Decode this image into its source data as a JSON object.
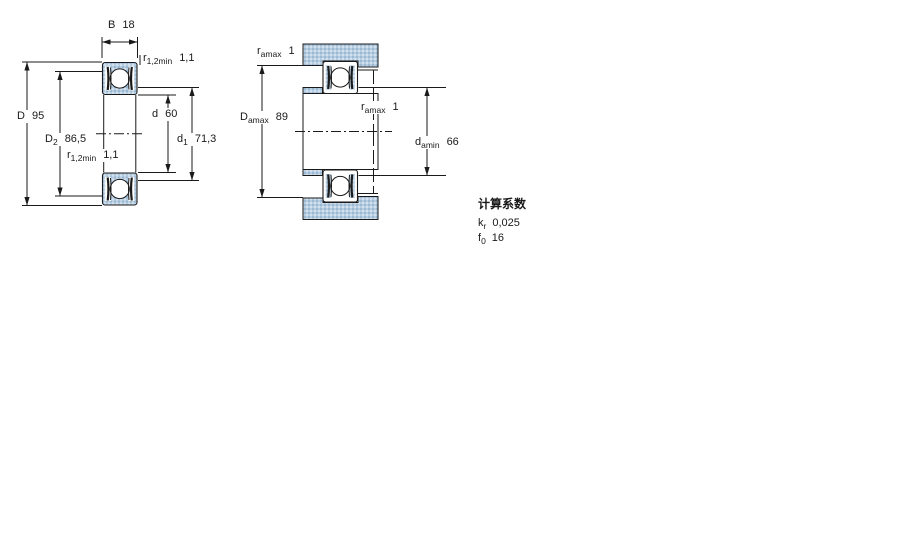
{
  "figures": {
    "left": {
      "name": "bearing-cross-section",
      "dims": {
        "B": {
          "base": "B",
          "sub": "",
          "value": "18"
        },
        "D": {
          "base": "D",
          "sub": "",
          "value": "95"
        },
        "D2": {
          "base": "D",
          "sub": "2",
          "value": "86,5"
        },
        "r_top": {
          "base": "r",
          "sub": "1,2min",
          "value": "1,1"
        },
        "d": {
          "base": "d",
          "sub": "",
          "value": "60"
        },
        "d1": {
          "base": "d",
          "sub": "1",
          "value": "71,3"
        },
        "r_bottom": {
          "base": "r",
          "sub": "1,2min",
          "value": "1,1"
        }
      }
    },
    "right": {
      "name": "abutment-dimensions",
      "dims": {
        "ra_top": {
          "base": "r",
          "sub": "amax",
          "value": "1"
        },
        "Da": {
          "base": "D",
          "sub": "amax",
          "value": "89"
        },
        "ra_mid": {
          "base": "r",
          "sub": "amax",
          "value": "1"
        },
        "da": {
          "base": "d",
          "sub": "amin",
          "value": "66"
        }
      }
    }
  },
  "factors": {
    "title": "计算系数",
    "rows": [
      {
        "base": "k",
        "sub": "r",
        "value": "0,025"
      },
      {
        "base": "f",
        "sub": "0",
        "value": "16"
      }
    ]
  },
  "colors": {
    "line": "#1a1a1a",
    "fill_base": "#b7cde1",
    "fill_dot_dark": "#9bb9d3",
    "fill_dot_light": "#d3e1ee"
  }
}
